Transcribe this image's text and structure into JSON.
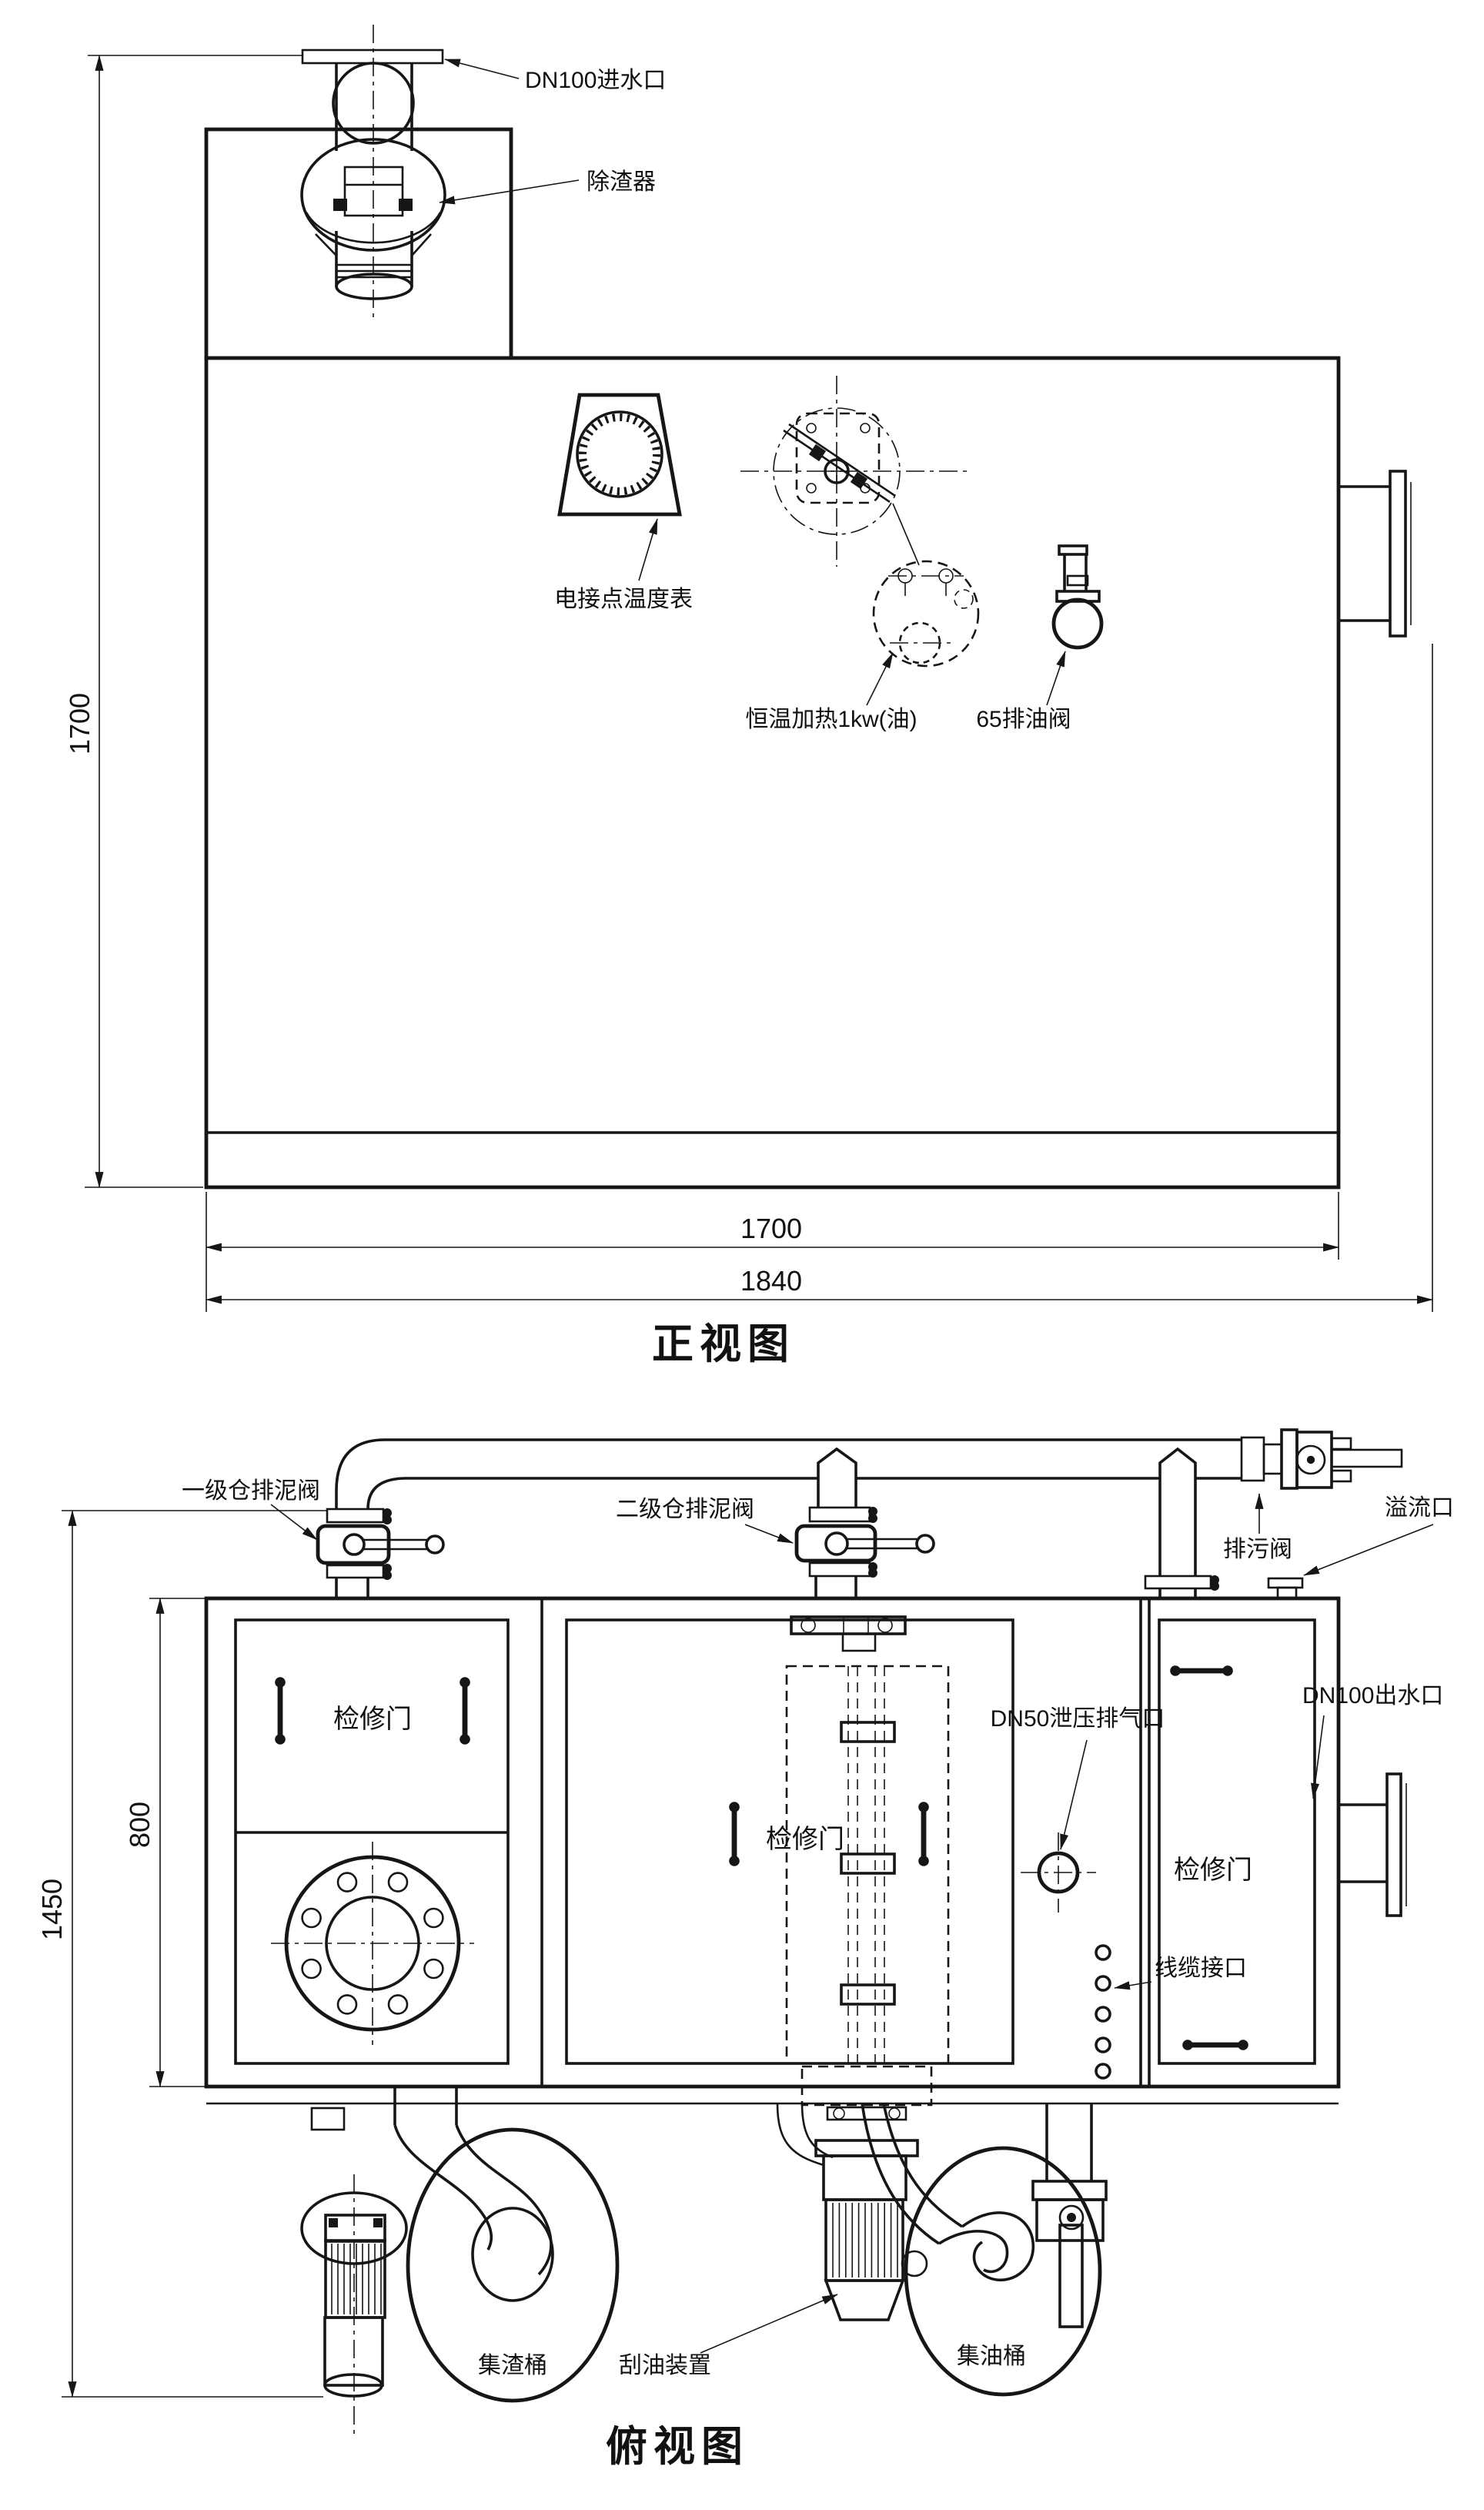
{
  "front": {
    "title": "正视图",
    "labels": {
      "inlet": "DN100进水口",
      "slag_remover": "除渣器",
      "thermometer": "电接点温度表",
      "heater": "恒温加热1kw(油)",
      "oil_drain_valve": "65排油阀"
    },
    "dims": {
      "height": "1700",
      "inner_width": "1700",
      "overall_width": "1840"
    }
  },
  "top": {
    "title": "俯视图",
    "labels": {
      "primary_mud_valve": "一级仓排泥阀",
      "secondary_mud_valve": "二级仓排泥阀",
      "blowdown_valve": "排污阀",
      "overflow_port": "溢流口",
      "outlet": "DN100出水口",
      "relief_vent": "DN50泄压排气口",
      "door_left": "检修门",
      "door_center": "检修门",
      "door_right": "检修门",
      "cable_port": "线缆接口",
      "slag_bucket": "集渣桶",
      "oil_scraper": "刮油装置",
      "oil_bucket": "集油桶"
    },
    "dims": {
      "depth": "800",
      "overall_height": "1450"
    }
  }
}
